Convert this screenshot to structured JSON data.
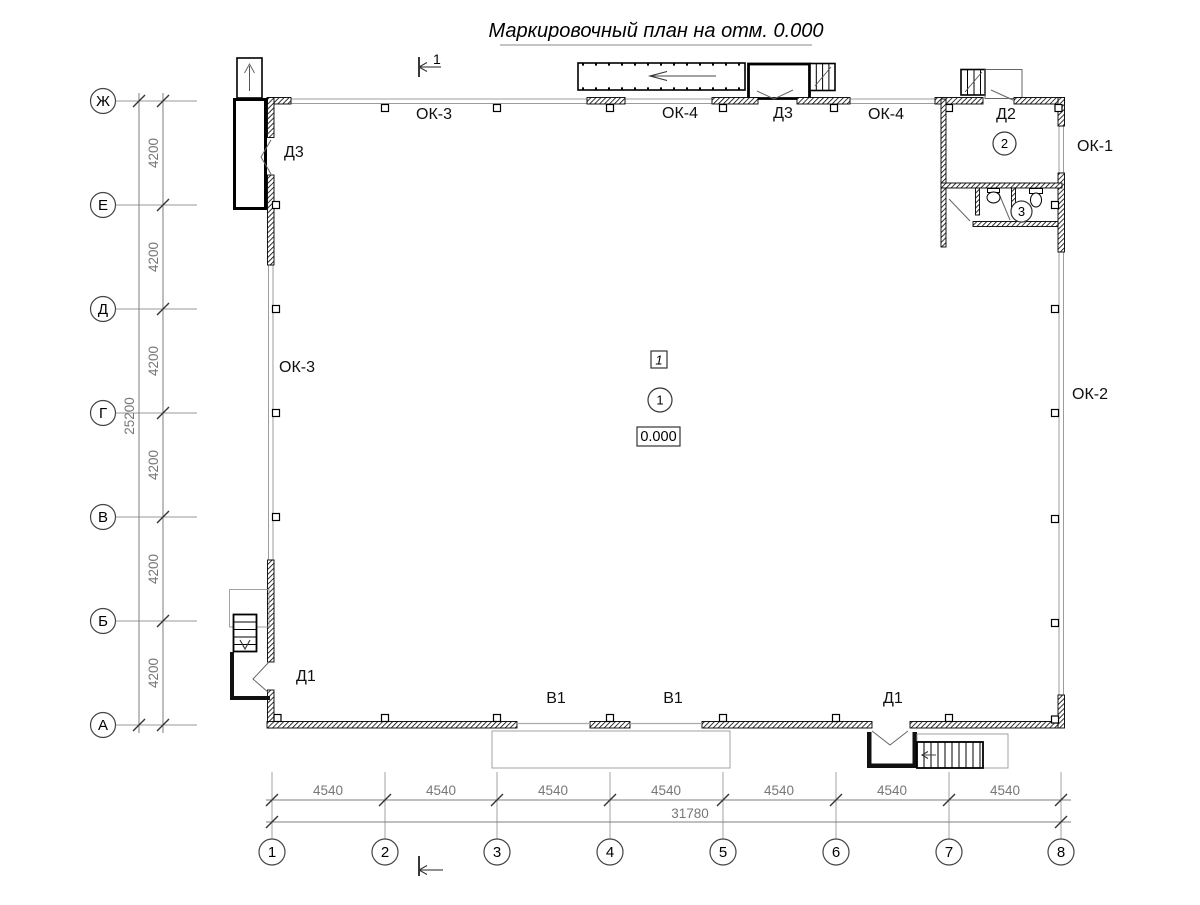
{
  "title": "Маркировочный план на отм. 0.000",
  "section_mark": "1",
  "axes": {
    "rows": [
      "Ж",
      "Е",
      "Д",
      "Г",
      "В",
      "Б",
      "А"
    ],
    "cols": [
      "1",
      "2",
      "3",
      "4",
      "5",
      "6",
      "7",
      "8"
    ]
  },
  "dims": {
    "bay_h": "4200",
    "total_h": "25200",
    "bay_w": "4540",
    "total_w": "31780"
  },
  "marks": {
    "ok1": "ОК-1",
    "ok2": "ОК-2",
    "ok3": "ОК-3",
    "ok4": "ОК-4",
    "d1": "Д1",
    "d2": "Д2",
    "d3": "Д3",
    "v1": "В1"
  },
  "hall": {
    "marker": "1",
    "number": "1",
    "elevation": "0.000"
  },
  "rooms": {
    "vestibule": "2",
    "washroom": "3"
  }
}
